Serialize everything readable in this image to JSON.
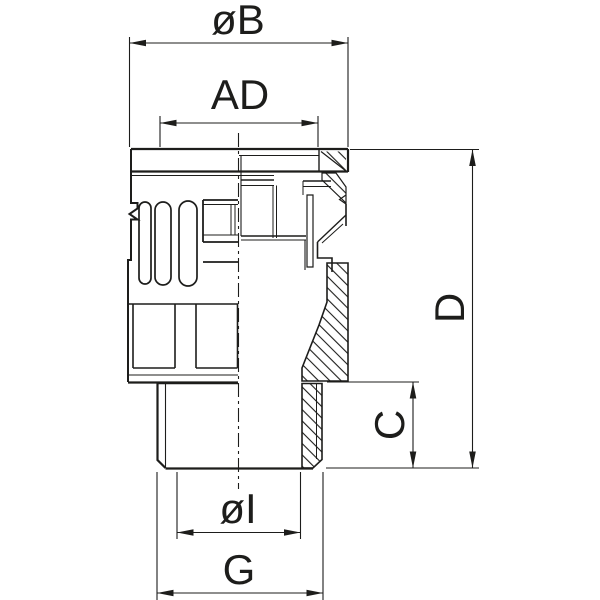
{
  "drawing": {
    "type": "technical-section-drawing",
    "background_color": "#ffffff",
    "line_color": "#1d1d1b",
    "dimension_labels": {
      "outer_diameter": "øB",
      "cap_width": "AD",
      "overall_height": "D",
      "thread_length": "C",
      "inner_diameter": "øI",
      "thread": "G"
    }
  }
}
